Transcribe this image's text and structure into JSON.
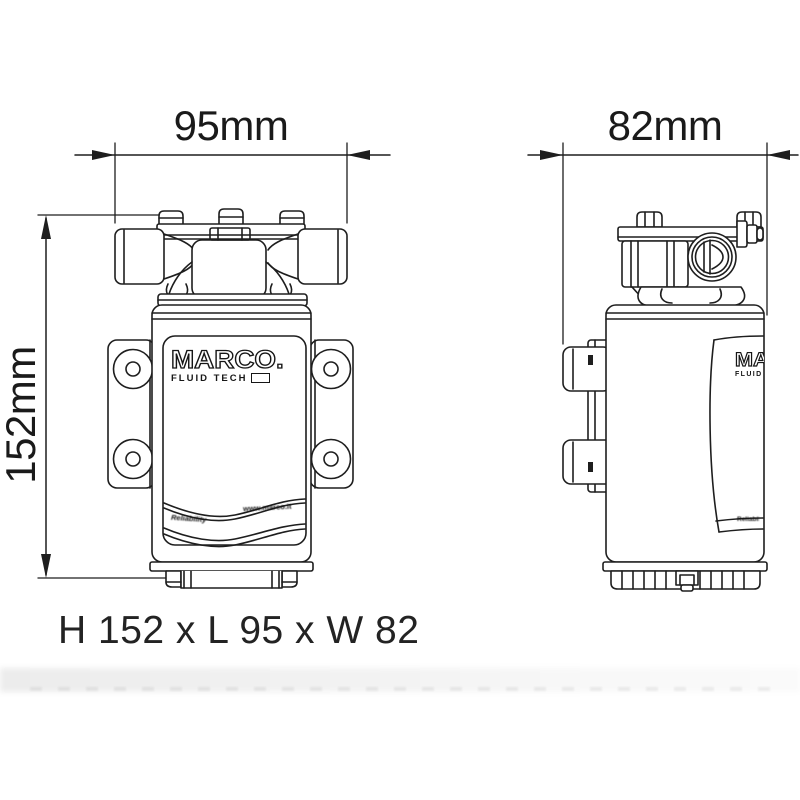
{
  "drawing": {
    "type": "technical-dimension-drawing",
    "subject": "Marco Fluid Tech electric gear pump, front and side orthographic views"
  },
  "dimensions": {
    "front_length": "95mm",
    "side_width": "82mm",
    "height": "152mm",
    "summary": "H 152 x L 95 x W 82"
  },
  "branding": {
    "logo_text": "MARCO.",
    "logo_subtext": "FLUID TECH",
    "ribbon_left": "Reliability",
    "ribbon_right": "www.marco.it"
  },
  "colors": {
    "line": "#1e1e1e",
    "background": "#ffffff",
    "text": "#1a1a1a"
  }
}
